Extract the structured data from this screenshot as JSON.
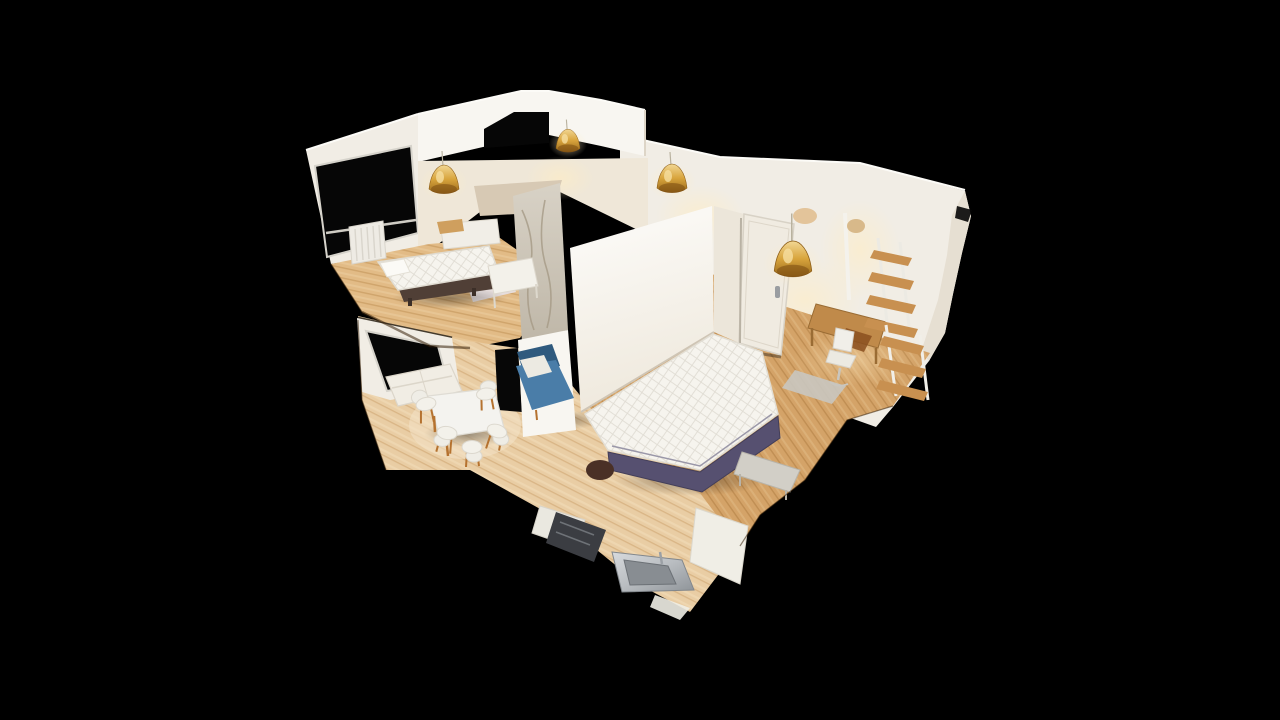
{
  "scene": {
    "type": "3d-dollhouse-apartment-scan",
    "description": "Overhead cutaway dollhouse view of a 3D-scanned apartment floating on a black background: two bedrooms with double beds, a living/dining room, a kitchen with sink, a bathroom block, a study with desk and ladder shelves, three dark window openings and four gold pendant lamps.",
    "background": "#000000",
    "palette": {
      "wallBright": "#f8f6f1",
      "wallLight": "#f1ede5",
      "wallWarm": "#efe7d8",
      "wallShade": "#ddd5c7",
      "wallEdge": "#e6dfd2",
      "windowBlack": "#060606",
      "frame": "#d6d3cb",
      "floorALight": "#e2bb86",
      "floorBMid": "#d4a368",
      "floorCLight": "#e9cda4",
      "plankSeam": "#b9884a",
      "marble": "#cfc8bb",
      "marbleStreak": "#a59a86",
      "gold": "#d8a43c",
      "goldDark": "#7a4a10",
      "goldLight": "#f2d794",
      "mattress": "#f6f4ee",
      "quiltLine": "#dedad1",
      "bedBase1": "#503f36",
      "bedBase2": "#565070",
      "blue": "#4a7da8",
      "blueDark": "#2f5a7e",
      "steel": "#b9bdc1",
      "steelDark": "#82878c",
      "appliance": "#3b3d42",
      "woodFurniture": "#c08a4a",
      "rugGray": "#c9c6c0",
      "rugLilac": "#e7e4ec",
      "door": "#f0ebe1",
      "glowWarm": "#ffe9bf",
      "white": "#f4f2ec"
    },
    "rooms": [
      {
        "id": "bedroom-1",
        "position": "top-left",
        "contents": "double bed, radiator, window, nightstand"
      },
      {
        "id": "hallway",
        "position": "center-top",
        "contents": "small white table, bathroom block"
      },
      {
        "id": "bathroom",
        "position": "center",
        "contents": "marble shower block"
      },
      {
        "id": "bedroom-2",
        "position": "center-right",
        "contents": "double bed with purple base, door, bench"
      },
      {
        "id": "study",
        "position": "right",
        "contents": "desk, office chair, two ladder shelves, gray rug"
      },
      {
        "id": "living-dining",
        "position": "bottom-left",
        "contents": "white sofa, dining table, five shell chairs, blue armchair, window"
      },
      {
        "id": "kitchen",
        "position": "bottom-center",
        "contents": "counters, dark appliance, stainless sink, cabinet"
      }
    ],
    "windows": {
      "count": 3,
      "color": "#060606"
    },
    "pendant_lamps": {
      "count": 4,
      "color": "#d8a43c"
    }
  }
}
